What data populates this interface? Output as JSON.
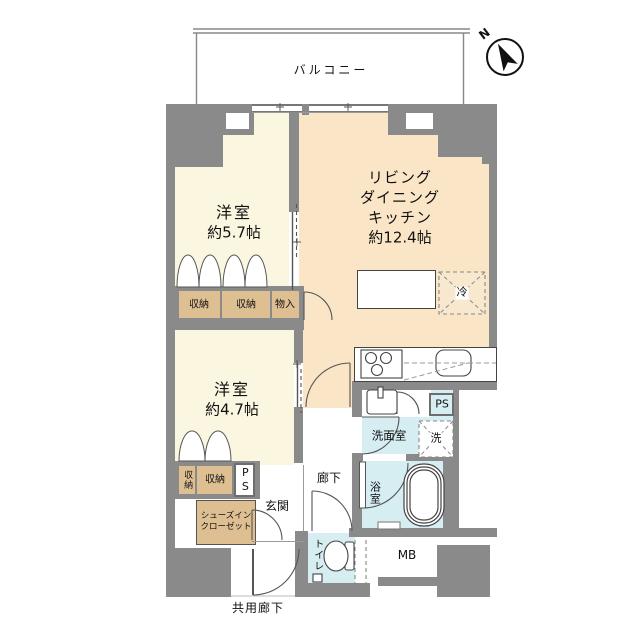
{
  "colors": {
    "wall": "#8a8a8a",
    "bedroom_floor": "#faf6e0",
    "ldk_floor": "#fae6c7",
    "closet": "#ddbf92",
    "wet_area": "#d6edf2",
    "outline": "#555555"
  },
  "compass": {
    "label": "N"
  },
  "balcony": {
    "label": "バルコニー"
  },
  "rooms": {
    "bedroom1": {
      "name": "洋室",
      "area": "約5.7帖"
    },
    "ldk": {
      "line1": "リビング",
      "line2": "ダイニング",
      "line3": "キッチン",
      "area": "約12.4帖"
    },
    "bedroom2": {
      "name": "洋室",
      "area": "約4.7帖"
    },
    "hallway": {
      "label": "廊下"
    },
    "entrance": {
      "label": "玄関"
    },
    "washroom": {
      "label": "洗面室"
    },
    "bathroom": {
      "label": "浴室"
    },
    "toilet": {
      "label": "トイレ"
    }
  },
  "storage": {
    "closet1a": "収納",
    "closet1b": "収納",
    "monoire": "物入",
    "closet2a": "収納",
    "closet2b": "収納",
    "sic1": "シューズイン",
    "sic2": "クローゼット"
  },
  "fixtures": {
    "fridge": "冷",
    "washer": "洗"
  },
  "service": {
    "ps_upper": "PS",
    "ps_lower": "PS",
    "mb": "MB"
  },
  "exterior": {
    "common_corridor": "共用廊下"
  }
}
